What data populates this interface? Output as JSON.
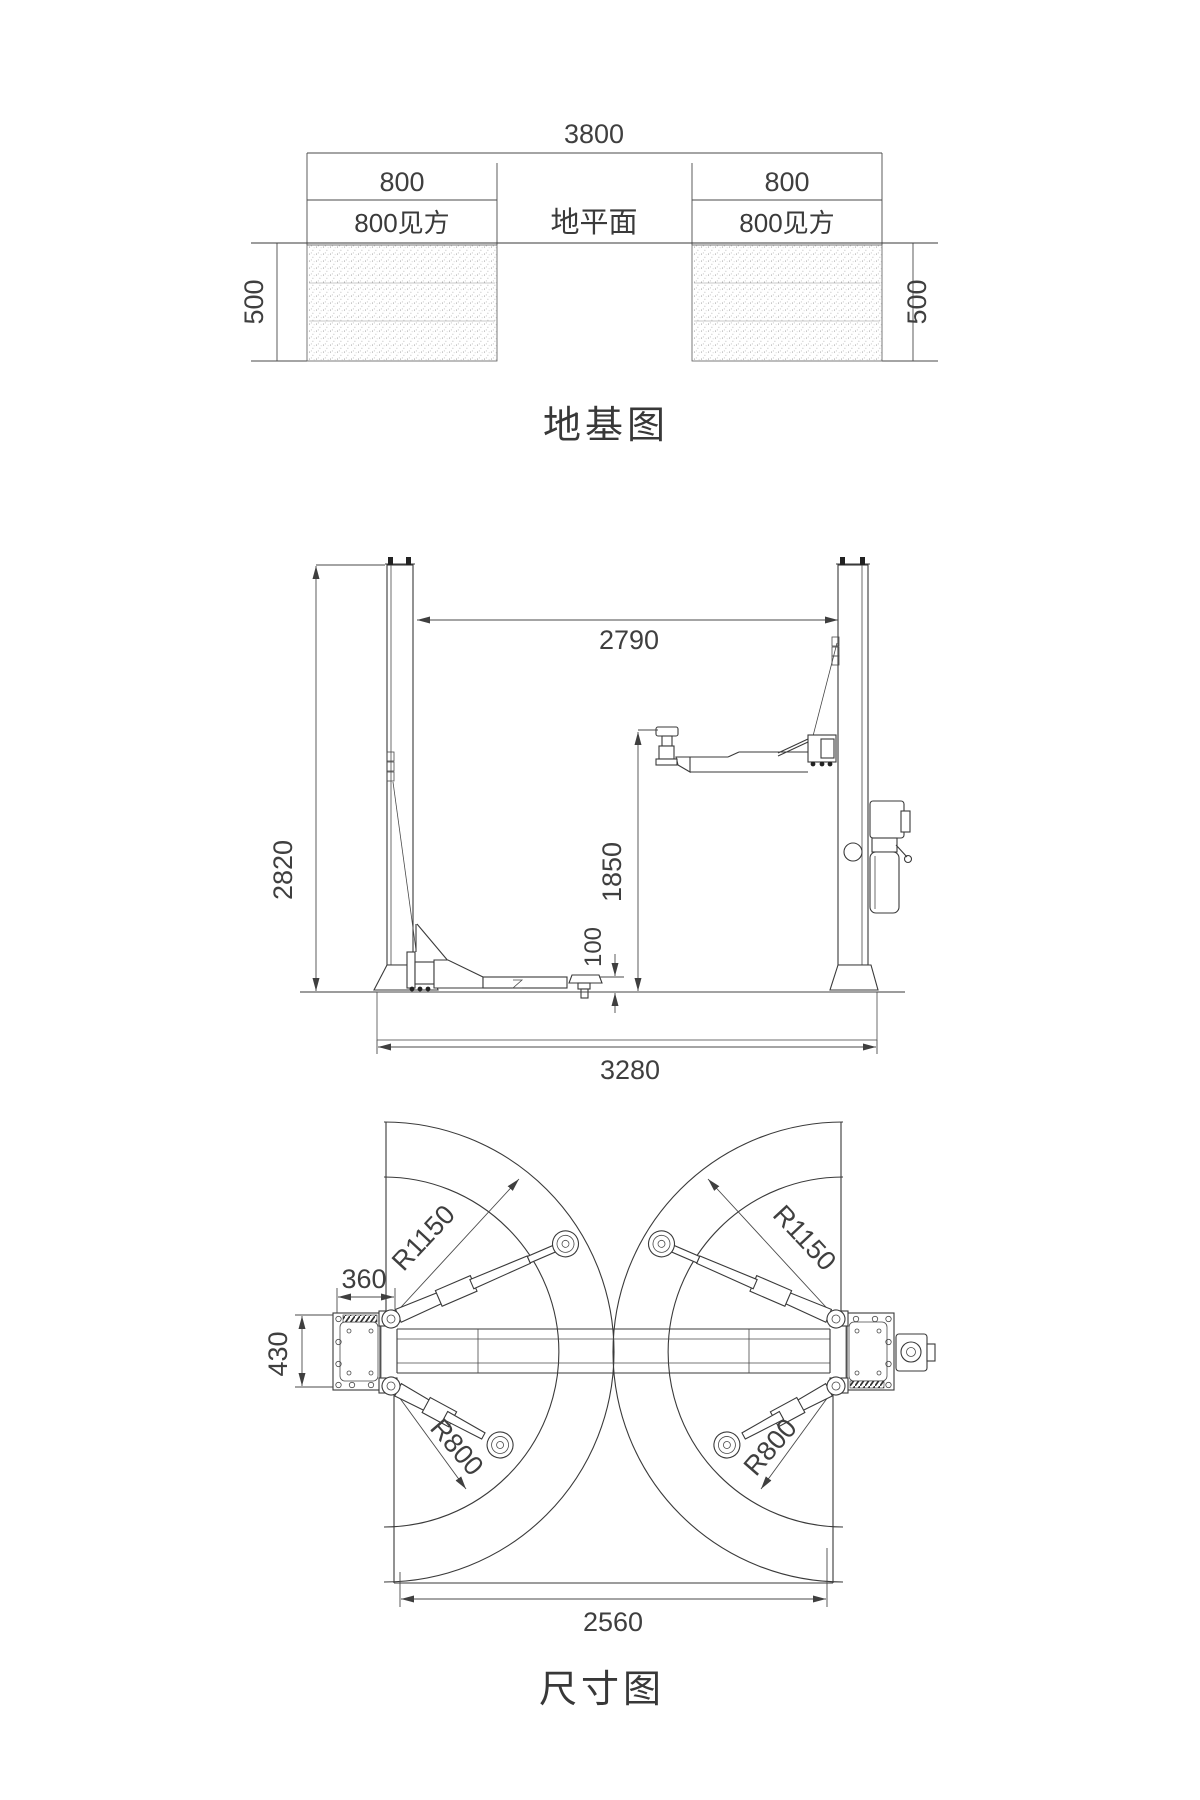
{
  "drawing": {
    "background": "#ffffff",
    "line_color": "#3a3a3a",
    "dim_color": "#4a4a4a"
  },
  "foundation_view": {
    "title": "地基图",
    "dim_total_width": "3800",
    "dim_block_width_left": "800",
    "dim_block_width_right": "800",
    "block_square_left": "800见方",
    "block_square_right": "800见方",
    "ground_plane_label": "地平面",
    "dim_depth_left": "500",
    "dim_depth_right": "500"
  },
  "elevation_view": {
    "dim_post_clearance": "2790",
    "dim_overall_height": "2820",
    "dim_lift_height": "1850",
    "dim_min_pad_height": "100",
    "dim_base_width": "3280"
  },
  "plan_view": {
    "title": "尺寸图",
    "dim_long_arm_radius_left": "R1150",
    "dim_long_arm_radius_right": "R1150",
    "dim_short_arm_radius_left": "R800",
    "dim_short_arm_radius_right": "R800",
    "dim_post_front_offset": "360",
    "dim_base_plate_depth": "430",
    "dim_inner_width": "2560"
  }
}
